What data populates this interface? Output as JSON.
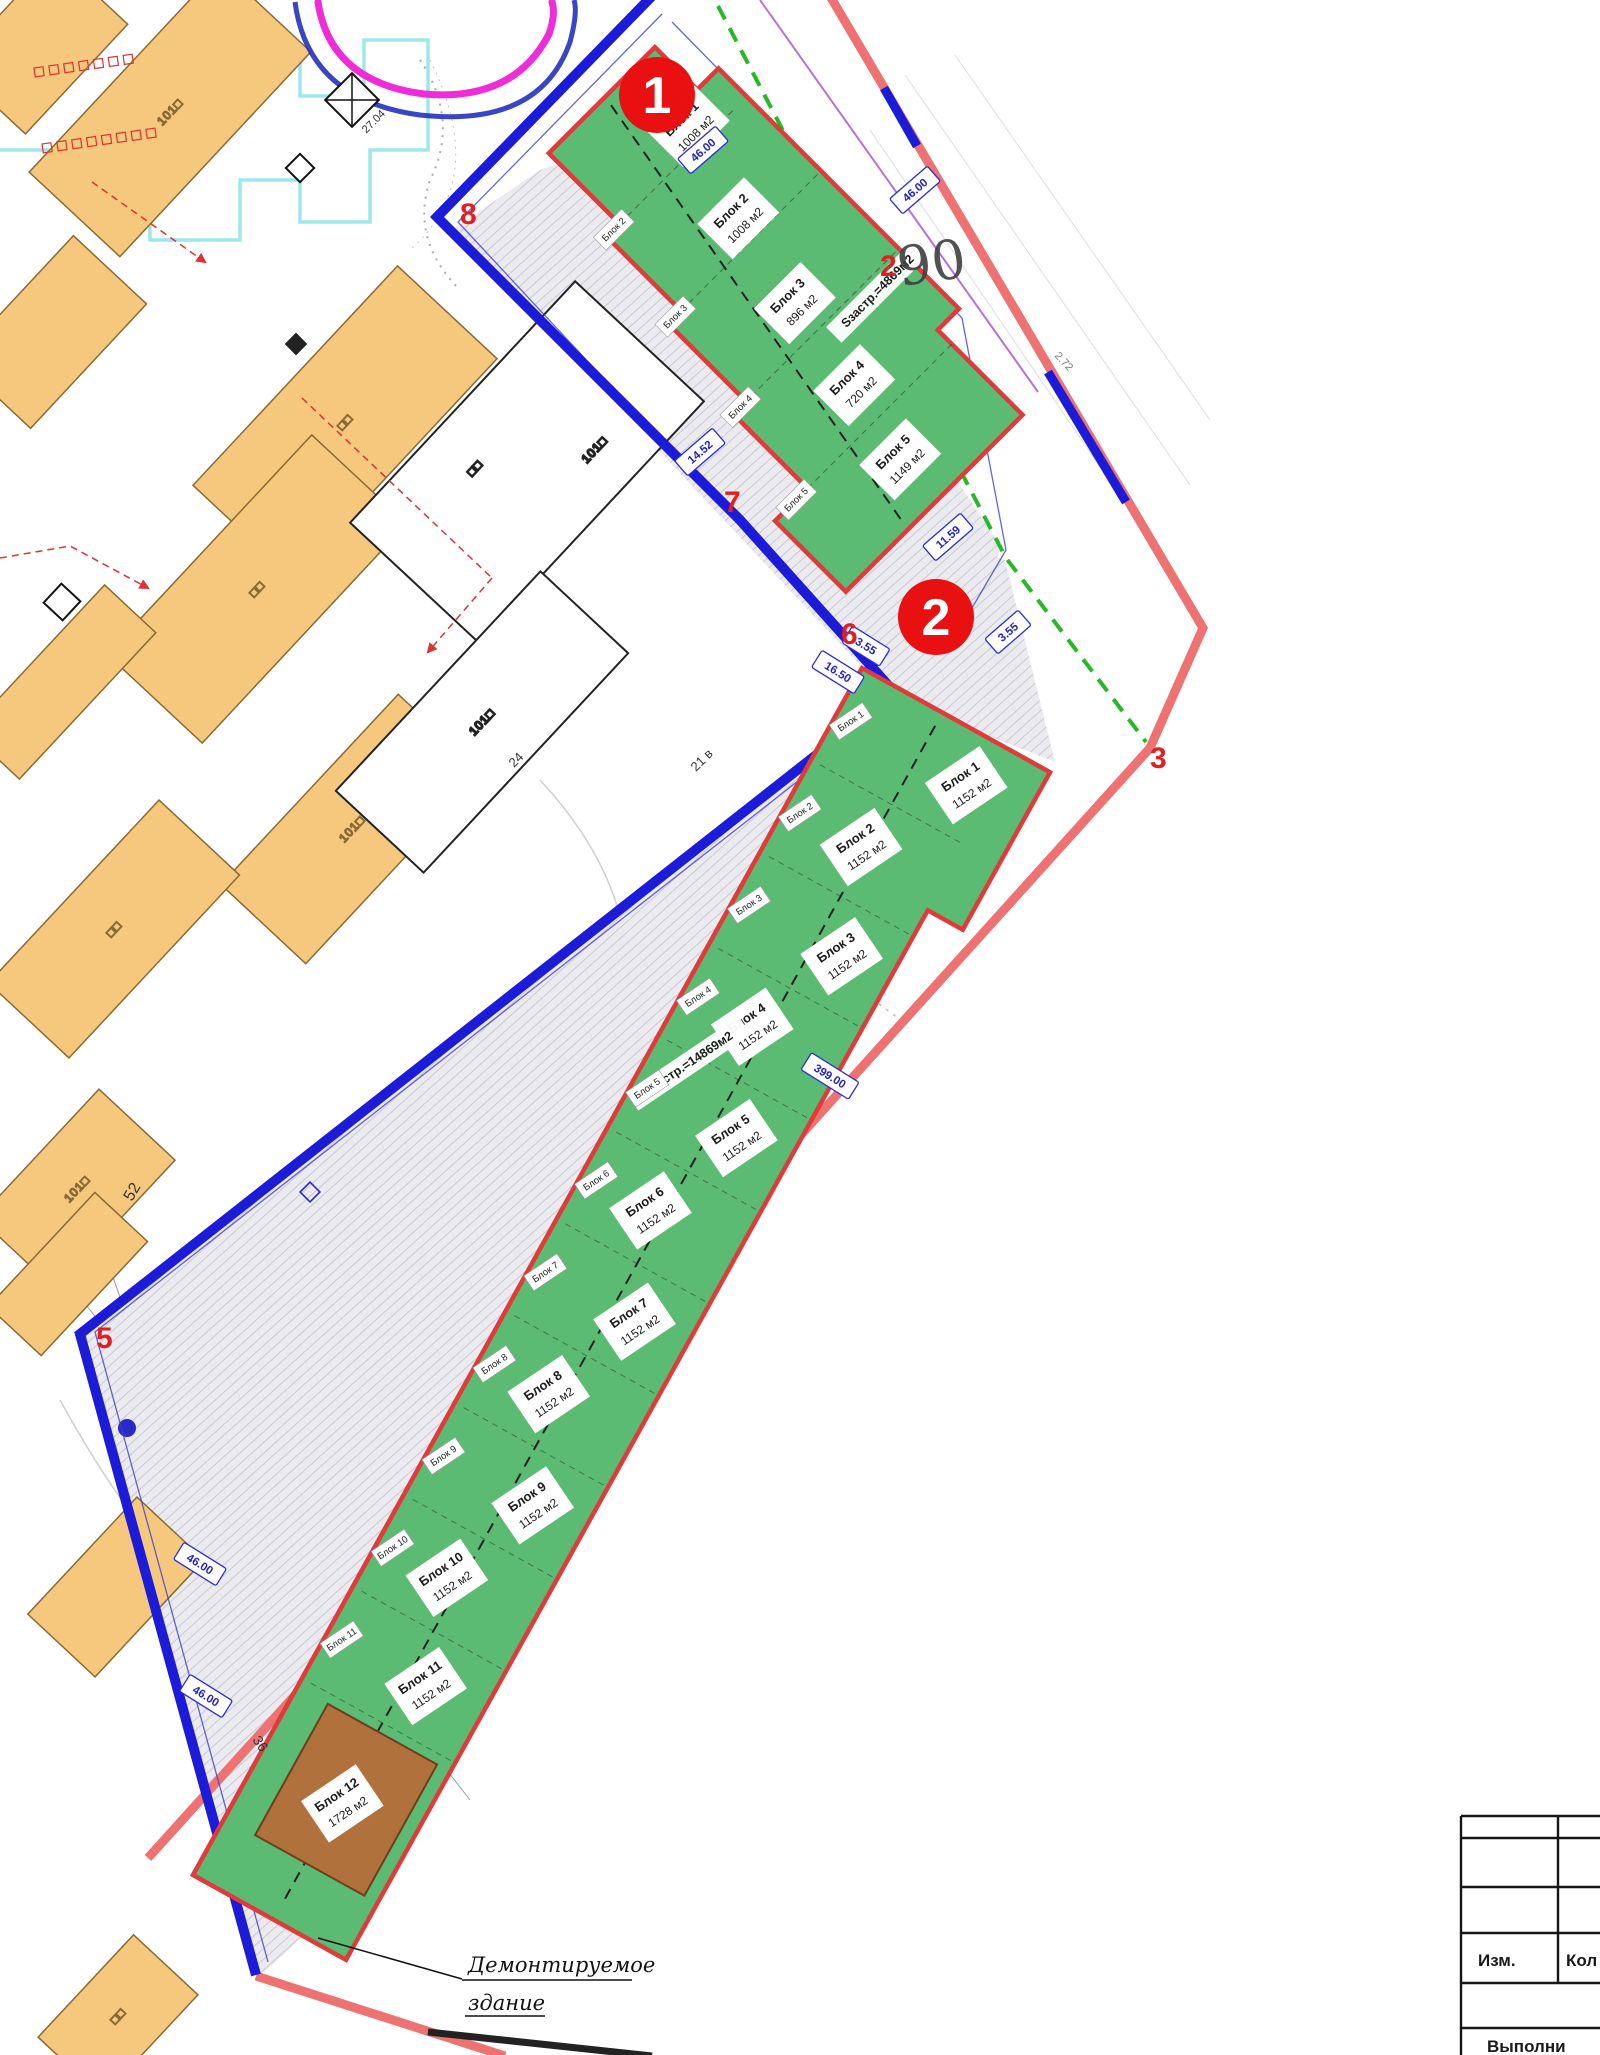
{
  "markers": {
    "m1": "1",
    "m2": "2"
  },
  "zones": [
    {
      "total_area_label": "Sзастр.=4869м2",
      "blocks": [
        {
          "label": "Блок 1",
          "area": "1008 м2"
        },
        {
          "label": "Блок 2",
          "area": "1008 м2"
        },
        {
          "label": "Блок 3",
          "area": "896 м2"
        },
        {
          "label": "Блок 4",
          "area": "720 м2"
        },
        {
          "label": "Блок 5",
          "area": "1149 м2"
        }
      ]
    },
    {
      "total_area_label": "Sзастр.=14869м2",
      "blocks": [
        {
          "label": "Блок 1",
          "area": "1152 м2"
        },
        {
          "label": "Блок 2",
          "area": "1152 м2"
        },
        {
          "label": "Блок 3",
          "area": "1152 м2"
        },
        {
          "label": "Блок 4",
          "area": "1152 м2"
        },
        {
          "label": "Блок 5",
          "area": "1152 м2"
        },
        {
          "label": "Блок 6",
          "area": "1152 м2"
        },
        {
          "label": "Блок 7",
          "area": "1152 м2"
        },
        {
          "label": "Блок 8",
          "area": "1152 м2"
        },
        {
          "label": "Блок 9",
          "area": "1152 м2"
        },
        {
          "label": "Блок 10",
          "area": "1152 м2"
        },
        {
          "label": "Блок 11",
          "area": "1152 м2"
        },
        {
          "label": "Блок 12",
          "area": "1728 м2"
        }
      ]
    }
  ],
  "boundary_vertices": [
    "8",
    "7",
    "6",
    "5",
    "3",
    "2"
  ],
  "dimension_tags": [
    "46.00",
    "46.00",
    "14.52",
    "11.59",
    "3.55",
    "3.55",
    "16.50",
    "399.00",
    "46.00",
    "46.00"
  ],
  "building_labels": [
    "101□",
    "□□",
    "□□",
    "101□",
    "□□",
    "101□",
    "□□",
    "101□",
    "101□",
    "□□"
  ],
  "misc_texts": {
    "plot_number": "90",
    "t52": "52",
    "t21": "21 в",
    "t24": "24",
    "t36": "36",
    "t2704": "27.04",
    "t272": "2.72"
  },
  "demolition_note": {
    "line1": "Демонтируемое",
    "line2": "здание"
  },
  "title_block": {
    "col_izm": "Изм.",
    "col_kol": "Кол",
    "bottom_row": "Выполни"
  },
  "colors": {
    "site_boundary_blue": "#1b1bd8",
    "outer_boundary_red": "#ee7272",
    "zone_fill_green": "#5cbb72",
    "zone_outline_red": "#e03a3a",
    "existing_building_orange": "#f6c87e",
    "marker_red": "#e81010",
    "utility_magenta": "#f02bd8",
    "utility_cyan": "#9de7ea",
    "utility_green": "#27b827",
    "block12_brown": "#b0713d"
  }
}
